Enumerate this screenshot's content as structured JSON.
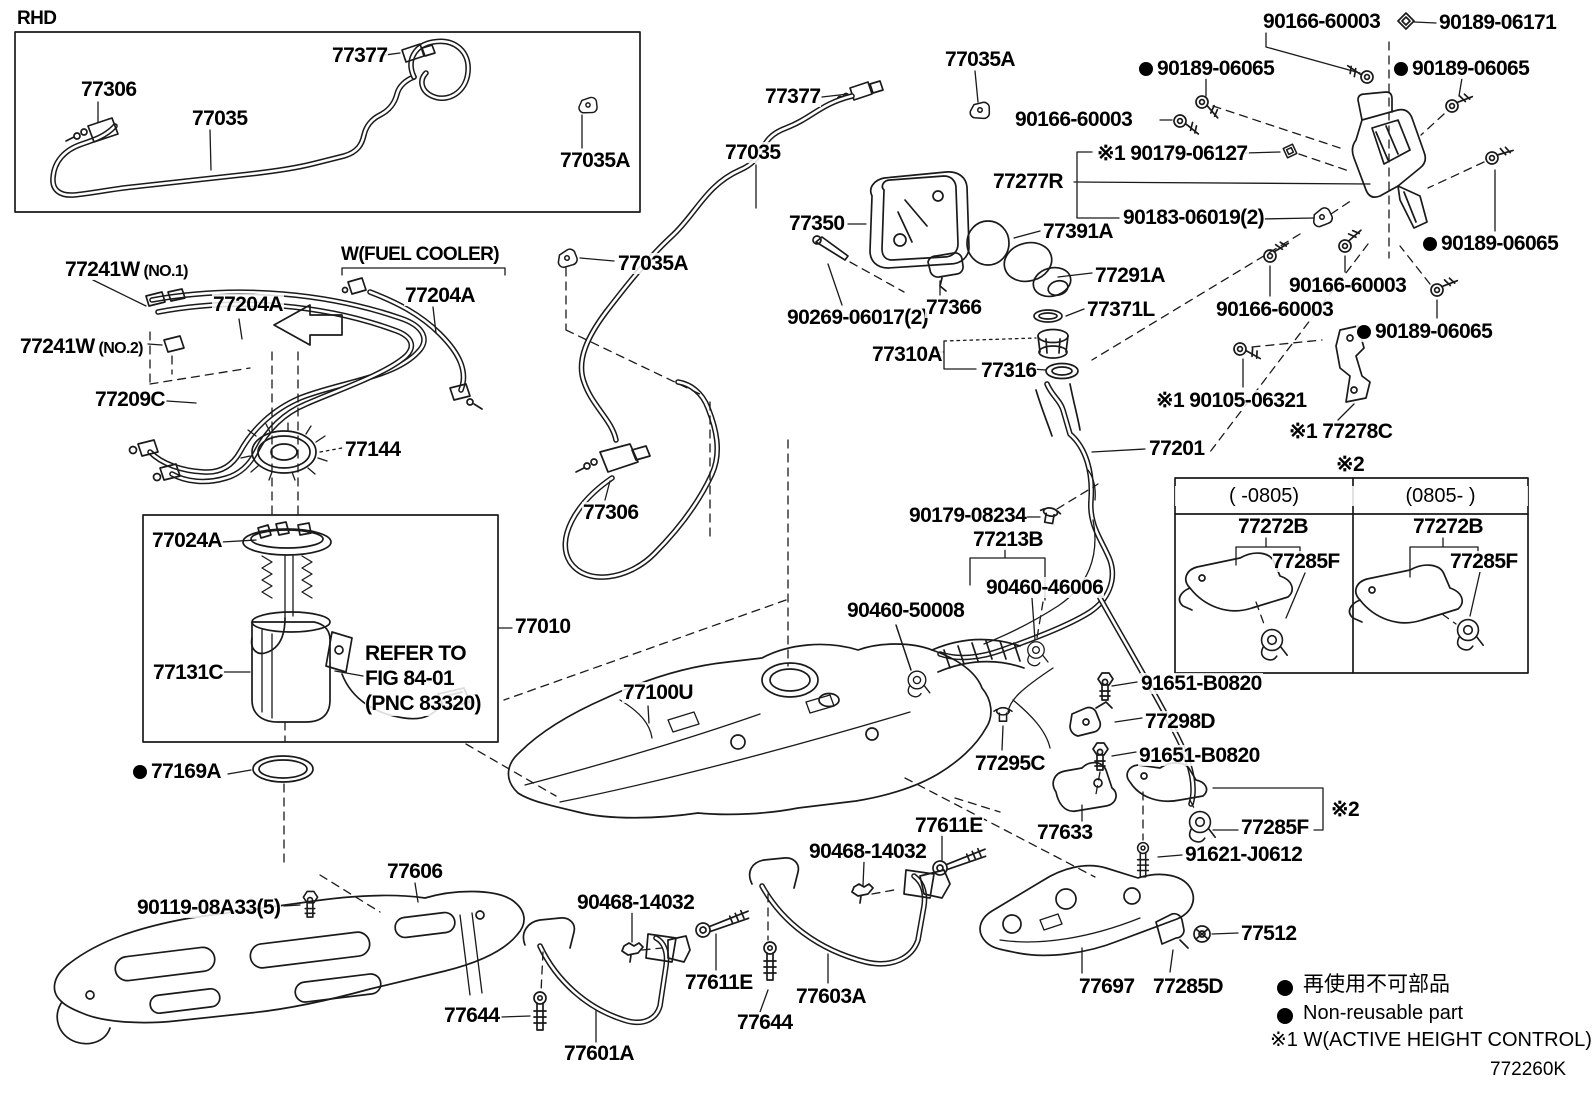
{
  "diagram": {
    "code": "772260K",
    "inset_title": "RHD",
    "fuel_cooler_note": "W(FUEL COOLER)",
    "refer_note": "REFER TO\nFIG 84-01\n(PNC 83320)",
    "legend": {
      "non_reusable_jp": "再使用不可部品",
      "non_reusable_en": "Non-reusable part",
      "note1": "※1 W(ACTIVE HEIGHT CONTROL)"
    },
    "variant_table": {
      "note": "※2",
      "columns": [
        {
          "header": "(   -0805)",
          "parts": [
            "77272B",
            "77285F"
          ]
        },
        {
          "header": "(0805-   )",
          "parts": [
            "77272B",
            "77285F"
          ]
        }
      ]
    }
  },
  "labels": [
    {
      "id": "77306-a",
      "t": "77306",
      "x": 80,
      "y": 79
    },
    {
      "id": "77035-a",
      "t": "77035",
      "x": 191,
      "y": 108
    },
    {
      "id": "77377-a",
      "t": "77377",
      "x": 331,
      "y": 45
    },
    {
      "id": "77035A-a",
      "t": "77035A",
      "x": 559,
      "y": 150
    },
    {
      "id": "77377-b",
      "t": "77377",
      "x": 764,
      "y": 86
    },
    {
      "id": "77035A-b",
      "t": "77035A",
      "x": 944,
      "y": 49
    },
    {
      "id": "77035-b",
      "t": "77035",
      "x": 724,
      "y": 142
    },
    {
      "id": "77035A-c",
      "t": "77035A",
      "x": 617,
      "y": 253
    },
    {
      "id": "77306-b",
      "t": "77306",
      "x": 582,
      "y": 502
    },
    {
      "id": "77350",
      "t": "77350",
      "x": 788,
      "y": 213
    },
    {
      "id": "90269-06017",
      "t": "90269-06017(2)",
      "x": 786,
      "y": 307
    },
    {
      "id": "77366",
      "t": "77366",
      "x": 925,
      "y": 297
    },
    {
      "id": "77391A",
      "t": "77391A",
      "x": 1042,
      "y": 221
    },
    {
      "id": "77291A",
      "t": "77291A",
      "x": 1094,
      "y": 265
    },
    {
      "id": "77371L",
      "t": "77371L",
      "x": 1086,
      "y": 299
    },
    {
      "id": "77310A",
      "t": "77310A",
      "x": 871,
      "y": 344
    },
    {
      "id": "77316",
      "t": "77316",
      "x": 980,
      "y": 360
    },
    {
      "id": "90166-60003-a",
      "t": "90166-60003",
      "x": 1262,
      "y": 11
    },
    {
      "id": "90189-06171",
      "t": "90189-06171",
      "x": 1438,
      "y": 12
    },
    {
      "id": "90189-06065-a",
      "t": "90189-06065",
      "x": 1138,
      "y": 58,
      "dot": true
    },
    {
      "id": "90189-06065-b",
      "t": "90189-06065",
      "x": 1393,
      "y": 58,
      "dot": true
    },
    {
      "id": "90166-60003-b",
      "t": "90166-60003",
      "x": 1014,
      "y": 109
    },
    {
      "id": "90179-06127",
      "t": "※1 90179-06127",
      "x": 1096,
      "y": 143
    },
    {
      "id": "77277R",
      "t": "77277R",
      "x": 992,
      "y": 171
    },
    {
      "id": "90183-06019",
      "t": "90183-06019(2)",
      "x": 1122,
      "y": 207
    },
    {
      "id": "90189-06065-c",
      "t": "90189-06065",
      "x": 1422,
      "y": 233,
      "dot": true
    },
    {
      "id": "90166-60003-c",
      "t": "90166-60003",
      "x": 1288,
      "y": 275
    },
    {
      "id": "90166-60003-d",
      "t": "90166-60003",
      "x": 1215,
      "y": 299
    },
    {
      "id": "90189-06065-d",
      "t": "90189-06065",
      "x": 1356,
      "y": 321,
      "dot": true
    },
    {
      "id": "90105-06321",
      "t": "※1 90105-06321",
      "x": 1155,
      "y": 390
    },
    {
      "id": "77278C",
      "t": "※1 77278C",
      "x": 1288,
      "y": 421
    },
    {
      "id": "77201",
      "t": "77201",
      "x": 1148,
      "y": 438
    },
    {
      "id": "77241W-1",
      "t": "77241W",
      "sub": "(NO.1)",
      "x": 64,
      "y": 259
    },
    {
      "id": "77204A-a",
      "t": "77204A",
      "x": 212,
      "y": 294
    },
    {
      "id": "77204A-b",
      "t": "77204A",
      "x": 404,
      "y": 285
    },
    {
      "id": "77241W-2",
      "t": "77241W",
      "sub": "(NO.2)",
      "x": 19,
      "y": 336
    },
    {
      "id": "77209C",
      "t": "77209C",
      "x": 94,
      "y": 389
    },
    {
      "id": "77144",
      "t": "77144",
      "x": 344,
      "y": 439
    },
    {
      "id": "77024A",
      "t": "77024A",
      "x": 151,
      "y": 530
    },
    {
      "id": "77131C",
      "t": "77131C",
      "x": 152,
      "y": 662
    },
    {
      "id": "77010",
      "t": "77010",
      "x": 514,
      "y": 616
    },
    {
      "id": "77169A",
      "t": "77169A",
      "x": 132,
      "y": 761,
      "dot": true
    },
    {
      "id": "77100U",
      "t": "77100U",
      "x": 622,
      "y": 682
    },
    {
      "id": "90179-08234",
      "t": "90179-08234",
      "x": 908,
      "y": 505
    },
    {
      "id": "77213B",
      "t": "77213B",
      "x": 972,
      "y": 529
    },
    {
      "id": "90460-46006",
      "t": "90460-46006",
      "x": 985,
      "y": 577
    },
    {
      "id": "90460-50008",
      "t": "90460-50008",
      "x": 846,
      "y": 600
    },
    {
      "id": "91651-B0820-a",
      "t": "91651-B0820",
      "x": 1140,
      "y": 673
    },
    {
      "id": "77298D",
      "t": "77298D",
      "x": 1144,
      "y": 711
    },
    {
      "id": "91651-B0820-b",
      "t": "91651-B0820",
      "x": 1138,
      "y": 745
    },
    {
      "id": "77295C",
      "t": "77295C",
      "x": 974,
      "y": 753
    },
    {
      "id": "77633",
      "t": "77633",
      "x": 1036,
      "y": 822
    },
    {
      "id": "77285F-main",
      "t": "77285F",
      "x": 1240,
      "y": 817
    },
    {
      "id": "note2-main",
      "t": "※2",
      "x": 1330,
      "y": 799
    },
    {
      "id": "91621-J0612",
      "t": "91621-J0612",
      "x": 1184,
      "y": 844
    },
    {
      "id": "77611E-r",
      "t": "77611E",
      "x": 914,
      "y": 815
    },
    {
      "id": "90468-14032-r",
      "t": "90468-14032",
      "x": 808,
      "y": 841
    },
    {
      "id": "77603A",
      "t": "77603A",
      "x": 795,
      "y": 986
    },
    {
      "id": "77644-c",
      "t": "77644",
      "x": 736,
      "y": 1012
    },
    {
      "id": "77611E-l",
      "t": "77611E",
      "x": 684,
      "y": 972
    },
    {
      "id": "90468-14032-l",
      "t": "90468-14032",
      "x": 576,
      "y": 892
    },
    {
      "id": "77601A",
      "t": "77601A",
      "x": 563,
      "y": 1043
    },
    {
      "id": "77644-l",
      "t": "77644",
      "x": 443,
      "y": 1005
    },
    {
      "id": "77606",
      "t": "77606",
      "x": 386,
      "y": 861
    },
    {
      "id": "90119-08A33",
      "t": "90119-08A33(5)",
      "x": 136,
      "y": 897
    },
    {
      "id": "77697",
      "t": "77697",
      "x": 1078,
      "y": 976
    },
    {
      "id": "77285D",
      "t": "77285D",
      "x": 1152,
      "y": 976
    },
    {
      "id": "77512",
      "t": "77512",
      "x": 1240,
      "y": 923
    }
  ]
}
